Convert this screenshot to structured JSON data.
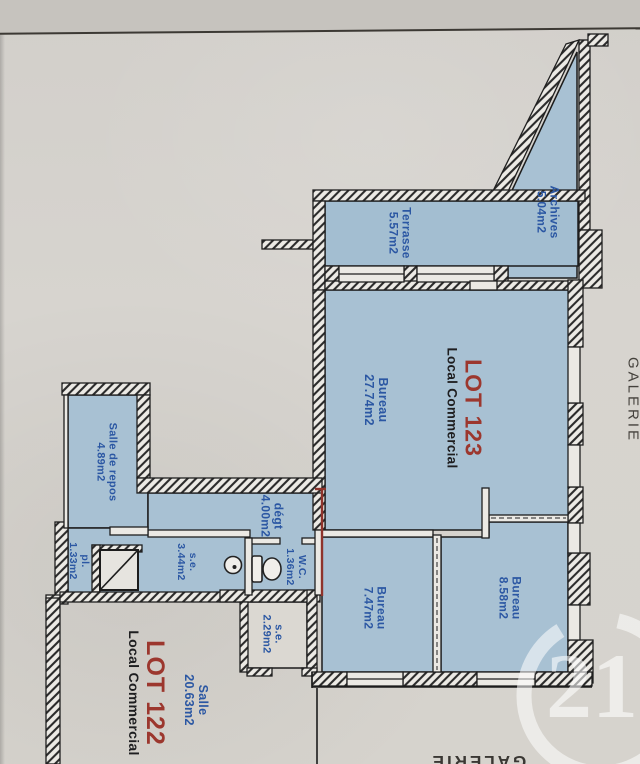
{
  "plan": {
    "lots": {
      "lot123": {
        "id": "LOT 123",
        "type": "Local Commercial"
      },
      "lot122": {
        "id": "LOT 122",
        "type": "Local Commercial"
      }
    },
    "rooms": {
      "archives": {
        "name": "Archives",
        "area": "5.04m2"
      },
      "terrasse": {
        "name": "Terrasse",
        "area": "5.57m2"
      },
      "bureau_main": {
        "name": "Bureau",
        "area": "27.74m2"
      },
      "salle_de_repos": {
        "name": "Salle de repos",
        "area": "4.89m2"
      },
      "degt": {
        "name": "dégt",
        "area": "4.00m2"
      },
      "se_haut": {
        "name": "s.e.",
        "area": "3.44m2"
      },
      "wc": {
        "name": "W.C.",
        "area": "1.36m2"
      },
      "pl": {
        "name": "pl.",
        "area": "1.33m2"
      },
      "se_bas": {
        "name": "s.e.",
        "area": "2.29m2"
      },
      "bureau_747": {
        "name": "Bureau",
        "area": "7.47m2"
      },
      "bureau_858": {
        "name": "Bureau",
        "area": "8.58m2"
      },
      "salle": {
        "name": "Salle",
        "area": "20.63m2"
      }
    },
    "annotations": {
      "galerie_right": "GALERIE",
      "galerie_bottom": "GALERIE"
    },
    "watermark": {
      "text": "21"
    },
    "colors": {
      "room_fill": "#a8c1d3",
      "label_blue": "#2b57a3",
      "lot_red": "#9c372e",
      "boundary_red": "#8f332b",
      "paper": "#d6d3cd"
    }
  }
}
